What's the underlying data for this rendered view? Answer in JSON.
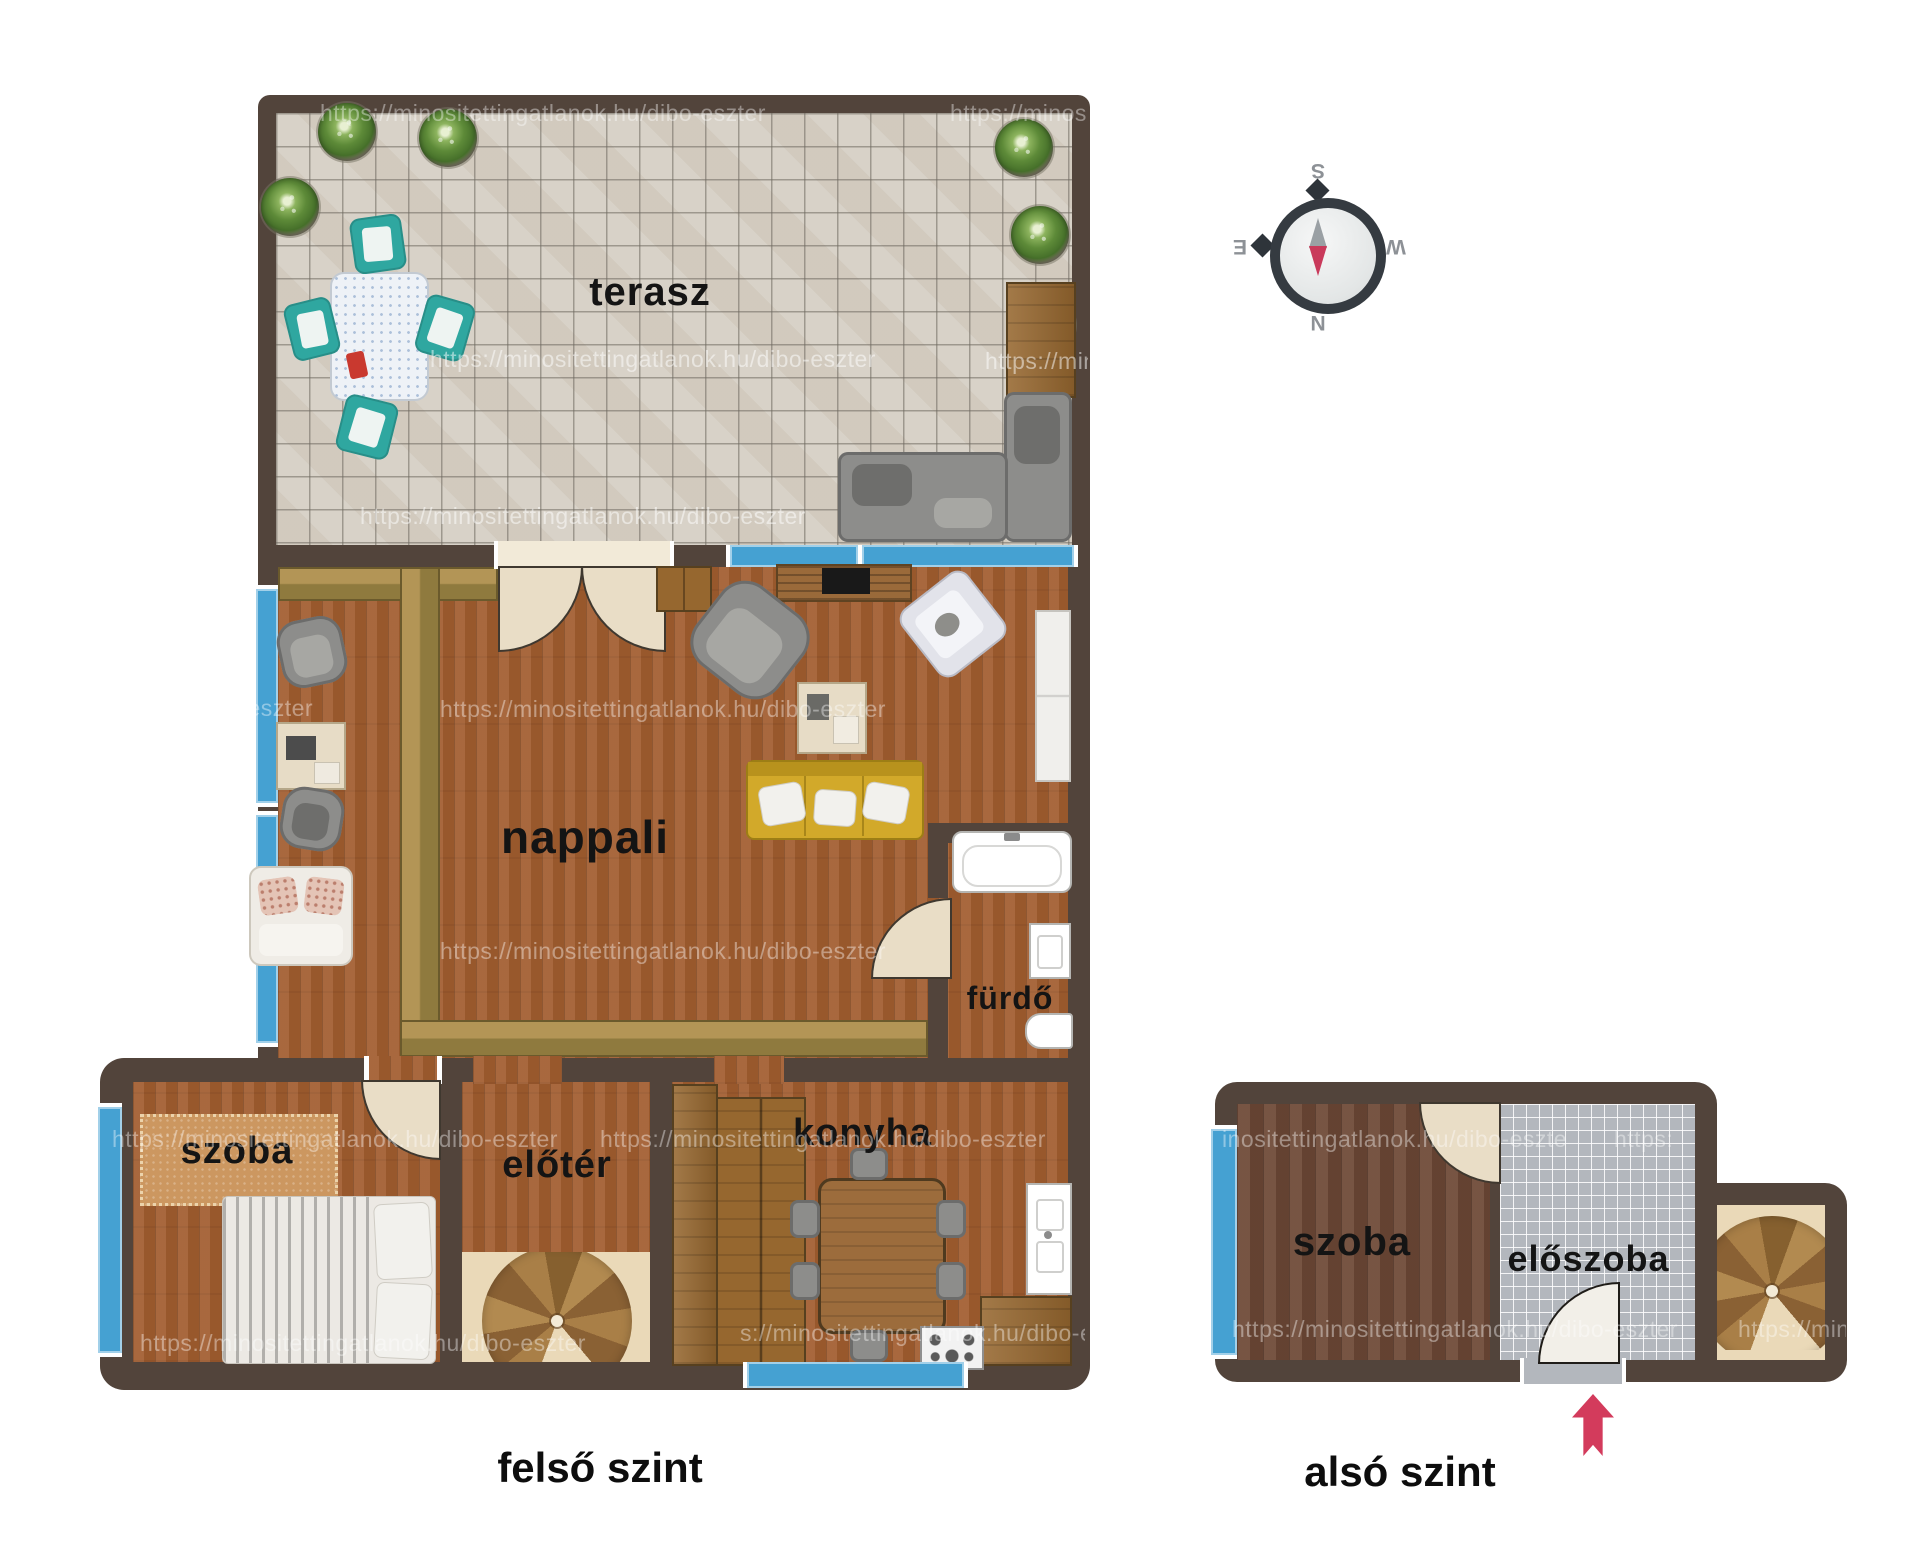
{
  "upper": {
    "caption": "felső szint",
    "terrace": "terasz",
    "living": "nappali",
    "bath": "fürdő",
    "bedroom": "szoba",
    "foyer": "előtér",
    "kitchen": "konyha"
  },
  "lower": {
    "caption": "alsó szint",
    "bedroom": "szoba",
    "hall": "előszoba"
  },
  "compass": {
    "top": "S",
    "right": "W",
    "bottom": "N",
    "left": "E"
  },
  "watermark": {
    "url": "https://minositettingatlanok.hu/dibo-eszter",
    "fragments": {
      "f1": "o-eszter",
      "f2": "s://minositettingatlanok.hu/dibo-eszter",
      "f3": "inositettingatlanok.hu/dibo-eszte",
      "f4": "https:",
      "f5": "https://mino",
      "f6": "ok.hu/dibo-eszter"
    }
  },
  "colors": {
    "wall": "#52443b",
    "window_blue": "#45a1d2",
    "wood_floor": "#a25d2f",
    "dark_wood_floor": "#6f4a37",
    "terrace_tile": "#d8d2c8",
    "hall_tile": "#b3b7bd",
    "sofa_yellow": "#d2a92a",
    "parquet_band": "#a08448",
    "arrow_red": "#d33b5c",
    "chair_teal": "#2fa7a0"
  }
}
